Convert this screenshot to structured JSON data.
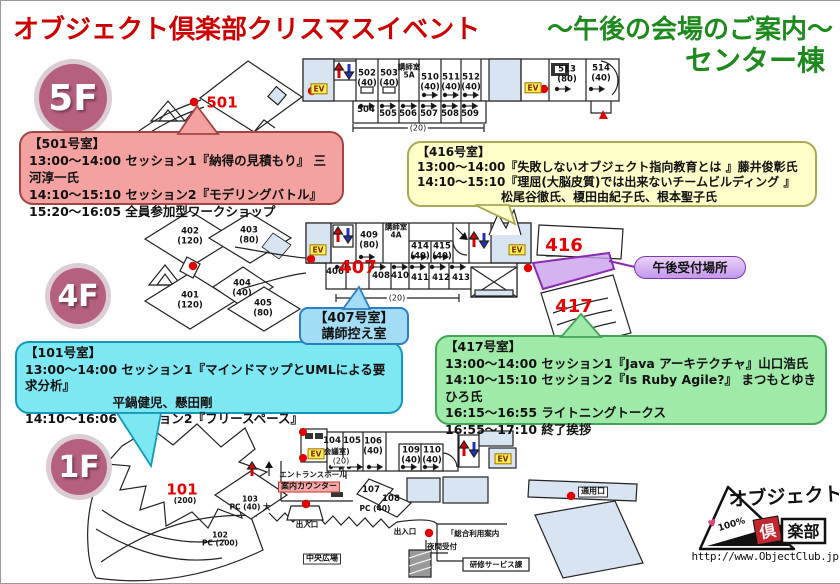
{
  "header": {
    "title_red": "オブジェクト倶楽部クリスマスイベント",
    "title_green": "～午後の会場のご案内～",
    "building": "センター棟"
  },
  "floor_badges": [
    {
      "label": "5F"
    },
    {
      "label": "4F"
    },
    {
      "label": "1F"
    }
  ],
  "callouts": {
    "room501": {
      "lines": [
        "【501号室】",
        "13:00～14:00 セッション1『納得の見積もり』 三河淳一氏",
        "14:10～15:10 セッション2『モデリングバトル』",
        "15:20～16:05 全員参加型ワークショップ"
      ]
    },
    "room416": {
      "lines": [
        "【416号室】",
        "13:00～14:00『失敗しないオブジェクト指向教育とは 』藤井俊彰氏",
        "14:10～15:10『理屈(大脳皮質)では出来ないチームビルディング 』",
        "　　　　　　　松尾谷徹氏、榎田由紀子氏、根本聖子氏"
      ]
    },
    "room101": {
      "lines": [
        "【101号室】",
        "13:00～14:00 セッション1『マインドマップとUMLによる要求分析』",
        "　　　　　　　平鍋健児、懸田剛",
        "14:10～16:06 セッション2『フリースペース』"
      ]
    },
    "room417": {
      "lines": [
        "【417号室】",
        "13:00～14:00 セッション1『Java アーキテクチャ』山口浩氏",
        "14:10～15:10 セッション2『Is Ruby Agile?』 まつもとゆきひろ氏",
        "16:15～16:55 ライトニングトークス",
        "16:55～17:10 終了挨拶"
      ]
    },
    "room407": {
      "lines": [
        "【407号室】",
        "講師控え室"
      ]
    },
    "reception": {
      "label": "午後受付場所"
    }
  },
  "plan_labels": [
    {
      "t": "501",
      "x": 221,
      "y": 102,
      "c": "bignum",
      "n": "room-501-number"
    },
    {
      "t": "502\n(40)",
      "x": 366,
      "y": 78
    },
    {
      "t": "503\n(40)",
      "x": 388,
      "y": 78
    },
    {
      "t": "講師室\n5A",
      "x": 408,
      "y": 71,
      "c": "sm"
    },
    {
      "t": "510\n(40)",
      "x": 429,
      "y": 82
    },
    {
      "t": "511\n(40)",
      "x": 450,
      "y": 82
    },
    {
      "t": "512\n(40)",
      "x": 470,
      "y": 82
    },
    {
      "t": "504",
      "x": 365,
      "y": 110
    },
    {
      "t": "505",
      "x": 387,
      "y": 114
    },
    {
      "t": "506",
      "x": 407,
      "y": 114
    },
    {
      "t": "507",
      "x": 428,
      "y": 114
    },
    {
      "t": "508",
      "x": 449,
      "y": 114
    },
    {
      "t": "509",
      "x": 469,
      "y": 114
    },
    {
      "t": "(20)",
      "x": 417,
      "y": 128,
      "c": "dim"
    },
    {
      "t": "513\n(80)",
      "x": 566,
      "y": 74
    },
    {
      "t": "514\n(40)",
      "x": 600,
      "y": 73
    },
    {
      "t": "EV",
      "x": 318,
      "y": 88,
      "c": "ev",
      "n": "elevator-5f-west"
    },
    {
      "t": "EV",
      "x": 532,
      "y": 87,
      "c": "ev",
      "n": "elevator-5f-east"
    },
    {
      "t": "402\n(120)",
      "x": 189,
      "y": 236
    },
    {
      "t": "403\n(80)",
      "x": 248,
      "y": 235
    },
    {
      "t": "401\n(120)",
      "x": 189,
      "y": 300
    },
    {
      "t": "404\n(40)",
      "x": 241,
      "y": 288
    },
    {
      "t": "405\n(80)",
      "x": 262,
      "y": 308
    },
    {
      "t": "406",
      "x": 334,
      "y": 272
    },
    {
      "t": "407",
      "x": 357,
      "y": 267,
      "c": "bignum-lg",
      "n": "room-407-number"
    },
    {
      "t": "408",
      "x": 380,
      "y": 276
    },
    {
      "t": "410",
      "x": 399,
      "y": 276
    },
    {
      "t": "411",
      "x": 419,
      "y": 278
    },
    {
      "t": "412",
      "x": 440,
      "y": 278
    },
    {
      "t": "413",
      "x": 460,
      "y": 278
    },
    {
      "t": "409\n(80)",
      "x": 368,
      "y": 240
    },
    {
      "t": "講師室\n4A",
      "x": 395,
      "y": 231,
      "c": "sm"
    },
    {
      "t": "414\n(40)",
      "x": 419,
      "y": 251
    },
    {
      "t": "415\n(40)",
      "x": 441,
      "y": 251
    },
    {
      "t": "(20)",
      "x": 396,
      "y": 298,
      "c": "dim"
    },
    {
      "t": "416",
      "x": 563,
      "y": 245,
      "c": "bignum-lg",
      "n": "room-416-number"
    },
    {
      "t": "417",
      "x": 573,
      "y": 306,
      "c": "bignum-lg",
      "n": "room-417-number"
    },
    {
      "t": "EV",
      "x": 317,
      "y": 249,
      "c": "ev",
      "n": "elevator-4f-west"
    },
    {
      "t": "EV",
      "x": 516,
      "y": 249,
      "c": "ev",
      "n": "elevator-4f-east"
    },
    {
      "t": "101",
      "x": 181,
      "y": 489,
      "c": "bignum",
      "n": "room-101-number"
    },
    {
      "t": "(200)",
      "x": 184,
      "y": 500,
      "c": "sm"
    },
    {
      "t": "102\nPC (200)",
      "x": 219,
      "y": 539,
      "c": "sm"
    },
    {
      "t": "103\nPC (40) 大",
      "x": 249,
      "y": 503,
      "c": "sm"
    },
    {
      "t": "エントランスホール",
      "x": 312,
      "y": 474,
      "c": "sm",
      "n": "entrance-hall-label"
    },
    {
      "t": "案内カウンター",
      "x": 308,
      "y": 486,
      "c": "hl",
      "n": "info-counter-label"
    },
    {
      "t": "出入口",
      "x": 306,
      "y": 524,
      "c": "sm",
      "n": "exit-south-label"
    },
    {
      "t": "104",
      "x": 331,
      "y": 441
    },
    {
      "t": "(会議室)",
      "x": 334,
      "y": 451,
      "c": "sm"
    },
    {
      "t": "(20)",
      "x": 340,
      "y": 461,
      "c": "dim"
    },
    {
      "t": "105",
      "x": 351,
      "y": 441
    },
    {
      "t": "106\n(40)",
      "x": 372,
      "y": 446
    },
    {
      "t": "109\n(40)",
      "x": 410,
      "y": 455
    },
    {
      "t": "110\n(40)",
      "x": 431,
      "y": 455
    },
    {
      "t": "107",
      "x": 370,
      "y": 490
    },
    {
      "t": "108",
      "x": 390,
      "y": 499
    },
    {
      "t": "PC (40)",
      "x": 374,
      "y": 508,
      "c": "sm"
    },
    {
      "t": "EV",
      "x": 315,
      "y": 453,
      "c": "ev",
      "n": "elevator-1f-west"
    },
    {
      "t": "EV",
      "x": 502,
      "y": 458,
      "c": "ev",
      "n": "elevator-1f-east"
    },
    {
      "t": "中央広場",
      "x": 321,
      "y": 558,
      "c": "tag",
      "n": "central-plaza-label"
    },
    {
      "t": "出入口",
      "x": 404,
      "y": 531,
      "c": "sm",
      "n": "exit-east-label"
    },
    {
      "t": "通用口",
      "x": 592,
      "y": 491,
      "c": "tag",
      "n": "service-entrance-label"
    },
    {
      "t": "「総合利用案内",
      "x": 472,
      "y": 533,
      "c": "sm",
      "n": "general-info-label"
    },
    {
      "t": "夜間受付",
      "x": 441,
      "y": 546,
      "c": "sm",
      "n": "night-reception-label"
    },
    {
      "t": "研修サービス課",
      "x": 495,
      "y": 564,
      "c": "sm",
      "n": "training-service-label"
    }
  ],
  "logo": {
    "brand_top": "オブジェクト",
    "brand_box1": "倶",
    "brand_box2": "楽部",
    "badge": "100%",
    "url": "http://www.ObjectClub.jp"
  },
  "colors": {
    "title_red": "#cc0000",
    "title_green": "#1e8a1e",
    "badge_pink": "#b4607e",
    "room_number_red": "#e60000",
    "callout_501": "#f4a1a1",
    "callout_416": "#ffffc9",
    "callout_101": "#7de8f2",
    "callout_417": "#9fe9a9",
    "callout_407": "#a3dcf5",
    "reception_purple": "#c497ec",
    "ev_yellow": "#ffee55",
    "lobby_blue": "#d9e4f2"
  }
}
